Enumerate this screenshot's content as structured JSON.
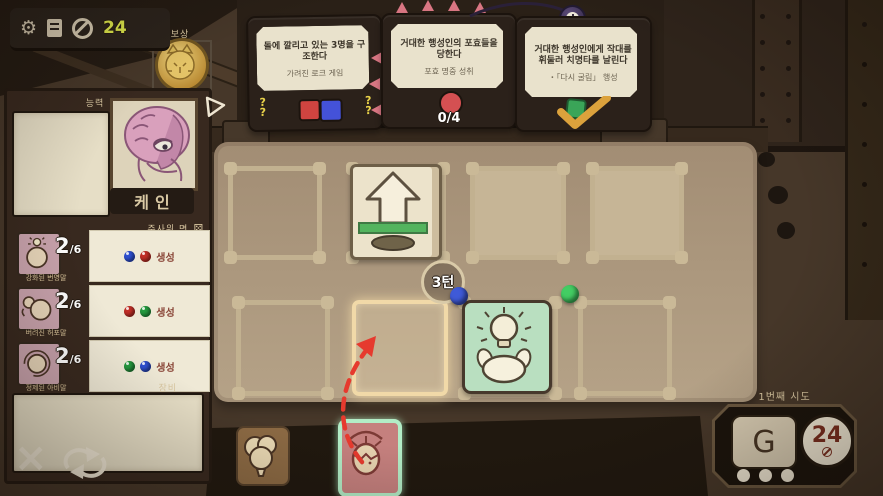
{
  "hud": {
    "coin_count": "24"
  },
  "icons": {
    "gear": "⚙",
    "dice_face": "⚄",
    "close": "×",
    "menu": "≡"
  },
  "reward": {
    "label": "보상"
  },
  "quests": {
    "cards": [
      {
        "title": "돌에 깔리고 있는 3명을 구조한다",
        "subtitle": "가려진 로크 게임",
        "mark": "?",
        "squares": {
          "red": "#cf4440",
          "blue": "#4452d9"
        }
      },
      {
        "title": "거대한 행성인의 포효들을 당한다",
        "subtitle": "포효 명중 성취",
        "progress": "0/4",
        "counter_color": "#d45052"
      },
      {
        "title": "거대한 행성인에게 작대를 휘둘러 치명타를 날린다",
        "subtitle": "・「다시 굴림」 행성"
      }
    ]
  },
  "character": {
    "ability_header": "능력",
    "name": "케인",
    "dice_header": "주사위 면",
    "equipment_header": "장비",
    "faces": [
      {
        "count": "2",
        "denom": "/6",
        "label": "강화된 번영말",
        "action": "생성",
        "dot1": "#2e4fd0",
        "dot2": "#c22f27"
      },
      {
        "count": "2",
        "denom": "/6",
        "label": "버려진 허포말",
        "action": "생성",
        "dot1": "#c22f27",
        "dot2": "#259a3f"
      },
      {
        "count": "2",
        "denom": "/6",
        "label": "정제된 아비말",
        "action": "생성",
        "dot1": "#259a3f",
        "dot2": "#2e4fd0"
      }
    ]
  },
  "board": {
    "turn": "3턴",
    "orbs": {
      "blue": "#3f5ad8",
      "green": "#43cd63"
    }
  },
  "attempt": {
    "label": "1번째 시도",
    "reroll_glyph": "G",
    "coin_value": "24"
  }
}
